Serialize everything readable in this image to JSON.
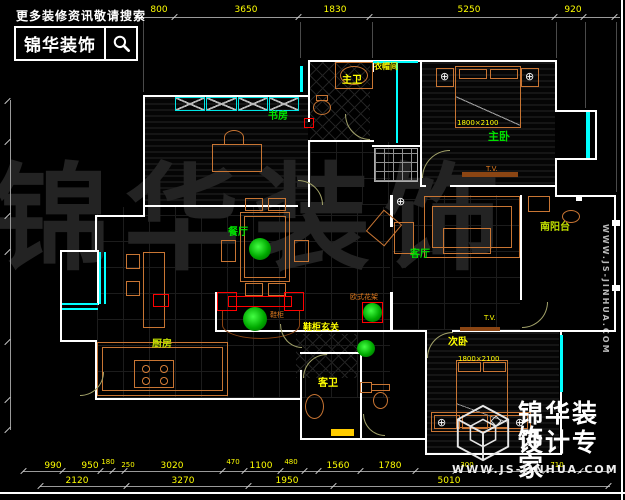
{
  "branding": {
    "tagline": "更多装修资讯敬请搜索",
    "logo_text": "锦华装饰",
    "search_icon": "magnifier"
  },
  "watermark": {
    "center_text": "锦华装饰",
    "side_url": "WWW.JS-JINHUA.COM"
  },
  "footer": {
    "brand": "锦华装饰",
    "slogan": "设计专家",
    "url": "WWW.JS-JINHUA.COM",
    "logo_icon": "wireframe-cube"
  },
  "rooms": {
    "study": "书房",
    "master_bath": "主卫",
    "cloakroom": "衣帽间",
    "master_bedroom": "主卧",
    "master_bed_size": "1800×2100",
    "master_tv": "T.V.",
    "balcony": "南阳台",
    "living": "客厅",
    "dining": "餐厅",
    "shoe_cabinet": "鞋柜",
    "entry": "鞋柜玄关",
    "flower_stand": "欧式花架",
    "kitchen": "厨房",
    "guest_bath": "客卫",
    "second_bedroom": "次卧",
    "second_bed_size": "1800×2100",
    "second_tv": "T.V."
  },
  "dimensions": {
    "top": [
      "800",
      "3650",
      "1830",
      "5250",
      "920"
    ],
    "bottom_row1": [
      "990",
      "950",
      "180",
      "250",
      "3020",
      "470",
      "1100",
      "480",
      "1560",
      "1780",
      "300",
      "710"
    ],
    "bottom_row2": [
      "2120",
      "3270",
      "1950",
      "5010"
    ]
  },
  "icons": {
    "lamp": "⊕"
  },
  "colors": {
    "wall": "#ffffff",
    "window": "#00ffff",
    "furniture": "#c87533",
    "dimension_text": "#ffff00",
    "label_green": "#00e000",
    "label_yellow": "#ffff00",
    "accent_red": "#ff0000"
  }
}
